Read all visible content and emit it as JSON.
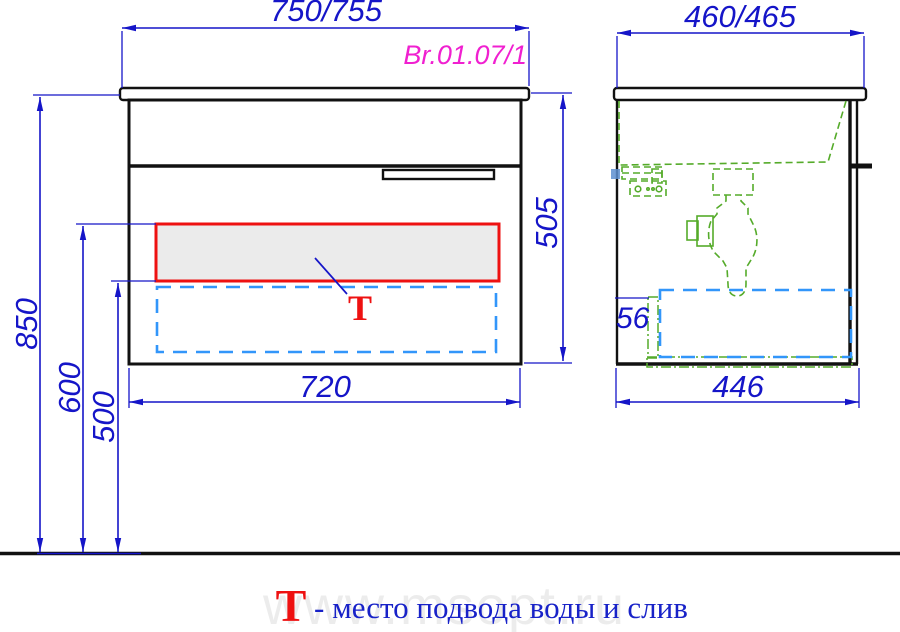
{
  "drawing": {
    "product_code": "Br.01.07/1",
    "watermark": "www.msopt.ru",
    "legend": {
      "symbol": "Т",
      "text": "- место подвода воды и слив"
    },
    "front_view": {
      "dim_width_top": "750/755",
      "dim_width_bottom": "720",
      "dim_height_floor_to_top": "850",
      "dim_height_supply": "600",
      "dim_height_drain": "500",
      "dim_height_cabinet": "505",
      "marker": "Т"
    },
    "side_view": {
      "dim_depth_top": "460/465",
      "dim_depth_bottom": "446",
      "dim_offset": "56"
    },
    "colors": {
      "dimension_blue": "#1515c8",
      "product_code_magenta": "#f020d0",
      "highlight_red": "#ee1111",
      "zone_dashed_blue": "#3296fa",
      "plumbing_green": "#55ab2a",
      "panel_fill_gray": "#ebebeb",
      "line_black": "#111111"
    }
  }
}
